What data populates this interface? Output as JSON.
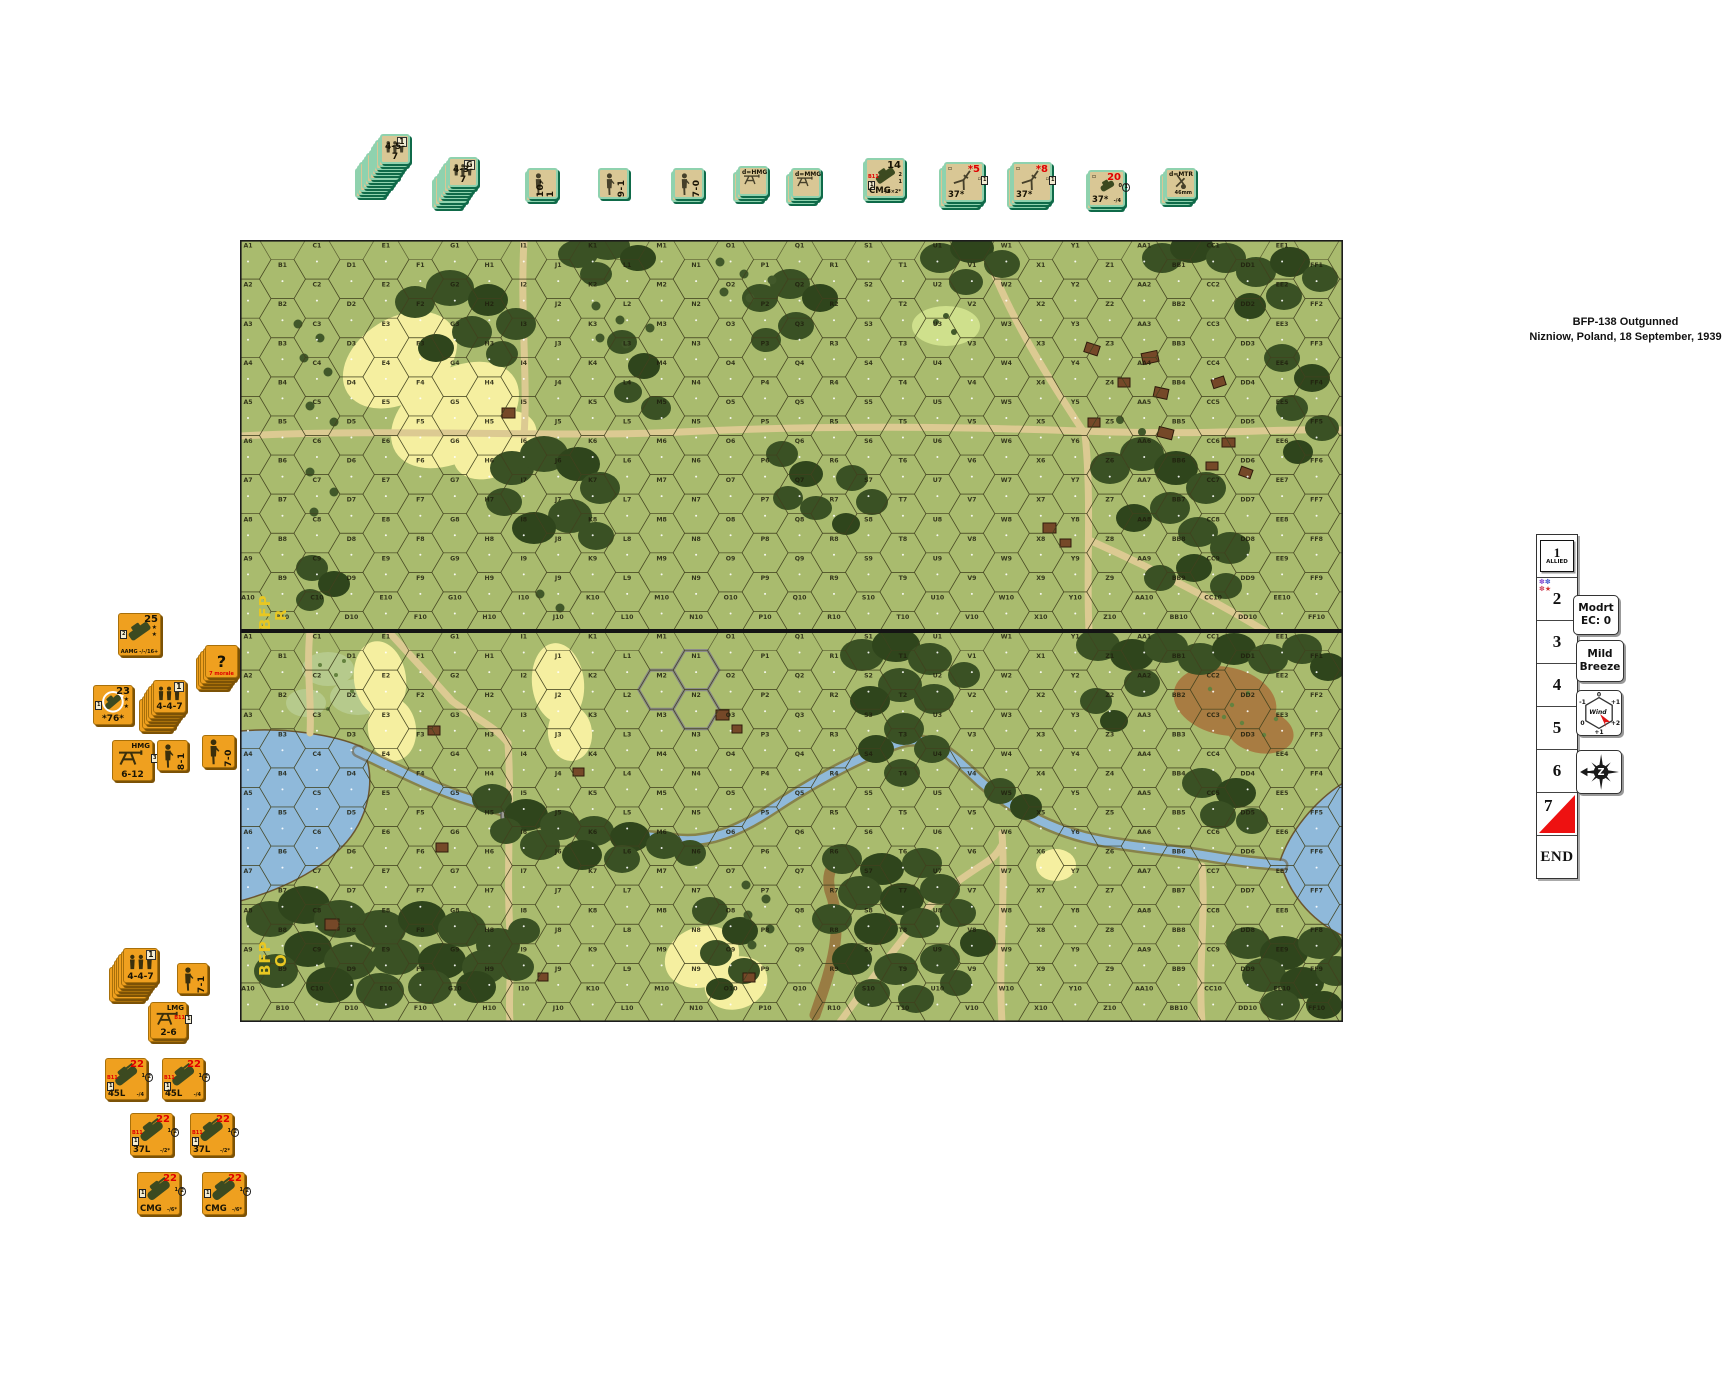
{
  "scenario": {
    "line1": "BFP-138  Outgunned",
    "line2": "Nizniow, Poland, 18 September, 1939"
  },
  "map": {
    "x": 240,
    "y": 240,
    "w": 1103,
    "h": 782,
    "board_h": 391,
    "rows": 10,
    "columns": [
      "A",
      "B",
      "C",
      "D",
      "E",
      "F",
      "G",
      "H",
      "I",
      "J",
      "K",
      "L",
      "M",
      "N",
      "O",
      "P",
      "Q",
      "R",
      "S",
      "T",
      "U",
      "V",
      "W",
      "X",
      "Y",
      "Z",
      "AA",
      "BB",
      "CC",
      "DD",
      "EE",
      "FF",
      "GG"
    ],
    "board_ids": [
      {
        "line1": "BFP",
        "line2": "R"
      },
      {
        "line1": "BFP",
        "line2": "O"
      }
    ],
    "colors": {
      "base": "#a9bb6e",
      "woods": "#3a5124",
      "grain": "#f5efa0",
      "road": "#dcca92",
      "water": "#8fb9da",
      "brush": "#b6ca8c",
      "building": "#754828",
      "brown_field": "#a87c42"
    }
  },
  "top_tray": {
    "counters": [
      {
        "id": "stack-4-5-7",
        "x": 380,
        "y": 134,
        "w": 30,
        "scheme": "tan",
        "stack": 12,
        "icon": "squad-icon",
        "tr": "1",
        "trBox": true,
        "bc": "4-5-7"
      },
      {
        "id": "stack-4-3-7",
        "x": 448,
        "y": 157,
        "w": 30,
        "scheme": "tan",
        "stack": 8,
        "icon": "squad-icon",
        "tr": "G",
        "trBox": true,
        "bc": "4-3-7"
      },
      {
        "id": "leader-10-1",
        "x": 527,
        "y": 168,
        "w": 31,
        "scheme": "tan",
        "stack": 2,
        "icon": "leader-icon",
        "right": "10-1"
      },
      {
        "id": "leader-9-1",
        "x": 598,
        "y": 168,
        "w": 31,
        "scheme": "tan",
        "stack": 1,
        "icon": "leader-icon",
        "right": "9-1"
      },
      {
        "id": "leader-7-0",
        "x": 673,
        "y": 168,
        "w": 31,
        "scheme": "tan",
        "stack": 2,
        "icon": "leader-icon",
        "right": "7-0"
      },
      {
        "id": "sw-dhmg",
        "x": 738,
        "y": 166,
        "w": 30,
        "scheme": "tan",
        "stack": 3,
        "icon": "mg-icon",
        "tl": "d=HMG"
      },
      {
        "id": "sw-dmmg",
        "x": 791,
        "y": 168,
        "w": 30,
        "scheme": "tan",
        "stack": 3,
        "icon": "mg-icon",
        "tl": "d=MMG"
      },
      {
        "id": "veh-cmg-14",
        "x": 865,
        "y": 158,
        "w": 40,
        "scheme": "tan",
        "stack": 2,
        "icon": "vehicle-icon",
        "vehIcon": true,
        "tr": "14",
        "lcol": [
          "r:B11",
          "b:1"
        ],
        "rcol": [
          "2",
          "1"
        ],
        "bl": "CMG",
        "br": "-/6×2*"
      },
      {
        "id": "gun-37-5",
        "x": 944,
        "y": 162,
        "w": 40,
        "scheme": "tan",
        "stack": 3,
        "icon": "gun-icon",
        "tl": "▫",
        "tr": "*5",
        "trRed": true,
        "rcol": [
          "b:1",
          "▫"
        ],
        "bl": "37*"
      },
      {
        "id": "gun-37-8",
        "x": 1012,
        "y": 162,
        "w": 40,
        "scheme": "tan",
        "stack": 3,
        "icon": "gun-icon",
        "tl": "▫",
        "tr": "*8",
        "trRed": true,
        "rcol": [
          "b:1",
          "▫"
        ],
        "bl": "37*"
      },
      {
        "id": "veh-37-20",
        "x": 1088,
        "y": 170,
        "w": 37,
        "scheme": "tan",
        "stack": 2,
        "icon": "tankette-icon",
        "vehIcon": true,
        "tl": "▫",
        "tr": "20",
        "trRed": true,
        "rcol": [
          "(1)",
          "0"
        ],
        "bl": "37*",
        "br": "-/4"
      },
      {
        "id": "sw-dmtr",
        "x": 1165,
        "y": 168,
        "w": 31,
        "scheme": "tan",
        "stack": 3,
        "icon": "mortar-icon",
        "tl": "d=MTR",
        "br": "46mm"
      }
    ]
  },
  "left_tray": {
    "counters": [
      {
        "id": "veh-aamg-25",
        "x": 118,
        "y": 613,
        "w": 43,
        "scheme": "or",
        "stack": 1,
        "icon": "vehicle-icon",
        "vehIcon": true,
        "tr": "25",
        "stars": 2,
        "lcol": [
          "b:2"
        ],
        "bc": "AAMG -/-/16+",
        "bcSmall": true
      },
      {
        "id": "concealment-stack",
        "x": 205,
        "y": 645,
        "w": 33,
        "scheme": "or",
        "stack": 5,
        "icon": "none",
        "center": "?",
        "bc": "7 morale",
        "bcRed": true,
        "bcSmall": true
      },
      {
        "id": "veh-76-23",
        "x": 93,
        "y": 685,
        "w": 40,
        "scheme": "or",
        "stack": 1,
        "icon": "turret-tank-icon",
        "vehIcon": true,
        "tr": "23",
        "stars": 2,
        "lcol": [
          "b:1"
        ],
        "bc": "*76*"
      },
      {
        "id": "stack-4-4-7-a",
        "x": 153,
        "y": 680,
        "w": 33,
        "scheme": "or",
        "stack": 7,
        "icon": "squad-icon",
        "tr": "1",
        "trBox": true,
        "bc": "4-4-7"
      },
      {
        "id": "sw-hmg",
        "x": 112,
        "y": 740,
        "w": 41,
        "scheme": "or",
        "stack": 1,
        "icon": "mg-icon",
        "tr": "HMG",
        "trSmall": true,
        "rcol": [
          "b:3"
        ],
        "bc": "6-12"
      },
      {
        "id": "leader-8-1",
        "x": 157,
        "y": 740,
        "w": 31,
        "scheme": "or",
        "stack": 1,
        "icon": "leader-icon",
        "right": "8-1"
      },
      {
        "id": "leader-7-0-r",
        "x": 202,
        "y": 735,
        "w": 33,
        "scheme": "or",
        "stack": 1,
        "icon": "leader-icon",
        "right": "7-0"
      },
      {
        "id": "stack-4-4-7-b",
        "x": 123,
        "y": 948,
        "w": 35,
        "scheme": "or",
        "stack": 7,
        "icon": "squad-icon",
        "tr": "1",
        "trBox": true,
        "bc": "4-4-7"
      },
      {
        "id": "leader-7-1",
        "x": 177,
        "y": 963,
        "w": 31,
        "scheme": "or",
        "stack": 1,
        "icon": "leader-icon",
        "right": "7-1"
      },
      {
        "id": "sw-lmg",
        "x": 150,
        "y": 1002,
        "w": 37,
        "scheme": "or",
        "stack": 2,
        "icon": "mg-icon",
        "tr": "LMG",
        "trSmall": true,
        "rcol": [
          "b:1",
          "r:B11"
        ],
        "bc": "2-6"
      },
      {
        "id": "tank-45l-a",
        "x": 105,
        "y": 1058,
        "w": 42,
        "scheme": "or",
        "stack": 1,
        "icon": "tank-icon",
        "vehIcon": true,
        "tr": "22",
        "trRed": true,
        "lcol": [
          "r:B11",
          "b:1"
        ],
        "rcol": [
          "(2)",
          "1"
        ],
        "bl": "45L",
        "br": "-/4"
      },
      {
        "id": "tank-45l-b",
        "x": 162,
        "y": 1058,
        "w": 42,
        "scheme": "or",
        "stack": 1,
        "icon": "tank-icon",
        "vehIcon": true,
        "tr": "22",
        "trRed": true,
        "lcol": [
          "r:B11",
          "b:1"
        ],
        "rcol": [
          "(2)",
          "1"
        ],
        "bl": "45L",
        "br": "-/4"
      },
      {
        "id": "tank-37l-a",
        "x": 130,
        "y": 1113,
        "w": 43,
        "scheme": "or",
        "stack": 1,
        "icon": "tank-icon",
        "vehIcon": true,
        "tr": "22",
        "trRed": true,
        "lcol": [
          "r:B11",
          "b:1"
        ],
        "rcol": [
          "(2)",
          "1"
        ],
        "bl": "37L",
        "br": "-/2*"
      },
      {
        "id": "tank-37l-b",
        "x": 190,
        "y": 1113,
        "w": 43,
        "scheme": "or",
        "stack": 1,
        "icon": "tank-icon",
        "vehIcon": true,
        "tr": "22",
        "trRed": true,
        "lcol": [
          "r:B11",
          "b:1"
        ],
        "rcol": [
          "(2)",
          "1"
        ],
        "bl": "37L",
        "br": "-/2*"
      },
      {
        "id": "tank-cmg-a",
        "x": 137,
        "y": 1172,
        "w": 43,
        "scheme": "or",
        "stack": 1,
        "icon": "tank-icon",
        "vehIcon": true,
        "tr": "22",
        "trRed": true,
        "lcol": [
          "b:1"
        ],
        "rcol": [
          "(2)",
          "1"
        ],
        "bl": "CMG",
        "br": "-/6*"
      },
      {
        "id": "tank-cmg-b",
        "x": 202,
        "y": 1172,
        "w": 43,
        "scheme": "or",
        "stack": 1,
        "icon": "tank-icon",
        "vehIcon": true,
        "tr": "22",
        "trRed": true,
        "lcol": [
          "b:1"
        ],
        "rcol": [
          "(2)",
          "1"
        ],
        "bl": "CMG",
        "br": "-/6*"
      }
    ]
  },
  "turn_track": {
    "x": 1536,
    "y": 534,
    "cell_w": 40,
    "cell_h": 42,
    "cells": [
      {
        "label": "1",
        "marker": "allied-chit",
        "chit": "ALLIED"
      },
      {
        "label": "2",
        "marker": "stars"
      },
      {
        "label": "3"
      },
      {
        "label": "4"
      },
      {
        "label": "5"
      },
      {
        "label": "6"
      },
      {
        "label": "7",
        "marker": "red-triangle"
      },
      {
        "label": "END"
      }
    ]
  },
  "side_markers": [
    {
      "id": "ec-marker",
      "type": "text2",
      "lines": [
        "Modrt",
        "EC: 0"
      ],
      "x": 1573,
      "y": 595,
      "w": 44,
      "h": 38
    },
    {
      "id": "breeze-marker",
      "type": "text2",
      "lines": [
        "Mild",
        "Breeze"
      ],
      "x": 1576,
      "y": 640,
      "w": 46,
      "h": 40
    },
    {
      "id": "wind-rose-marker",
      "type": "windrose",
      "label": "Wind",
      "ticks": [
        "-1",
        "0",
        "+1",
        "0",
        "+1",
        "+2"
      ],
      "x": 1576,
      "y": 690,
      "w": 44,
      "h": 44
    },
    {
      "id": "compass-marker",
      "type": "compass",
      "letter": "Z",
      "x": 1576,
      "y": 750,
      "w": 44,
      "h": 42
    }
  ]
}
